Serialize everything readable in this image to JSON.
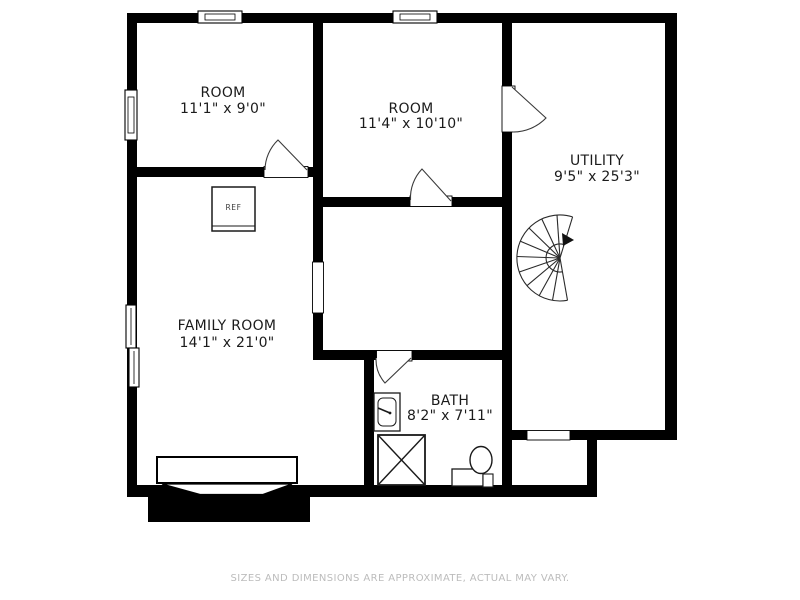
{
  "page": {
    "background": "#ffffff",
    "footer": {
      "disclaimer": "SIZES AND DIMENSIONS ARE APPROXIMATE, ACTUAL MAY VARY."
    }
  },
  "floorplan": {
    "rooms": {
      "room1": {
        "name": "ROOM",
        "dimensions": "11'1\" x 9'0\""
      },
      "room2": {
        "name": "ROOM",
        "dimensions": "11'4\" x 10'10\""
      },
      "utility": {
        "name": "UTILITY",
        "dimensions": "9'5\" x 25'3\""
      },
      "family_room": {
        "name": "FAMILY ROOM",
        "dimensions": "14'1\" x 21'0\""
      },
      "bath": {
        "name": "BATH",
        "dimensions": "8'2\" x 7'11\""
      }
    },
    "fixtures": {
      "refrigerator_label": "REF"
    },
    "colors": {
      "wall": "#000000",
      "label_text": "#1b1b1b",
      "footer_text": "#bcbcbc"
    }
  }
}
